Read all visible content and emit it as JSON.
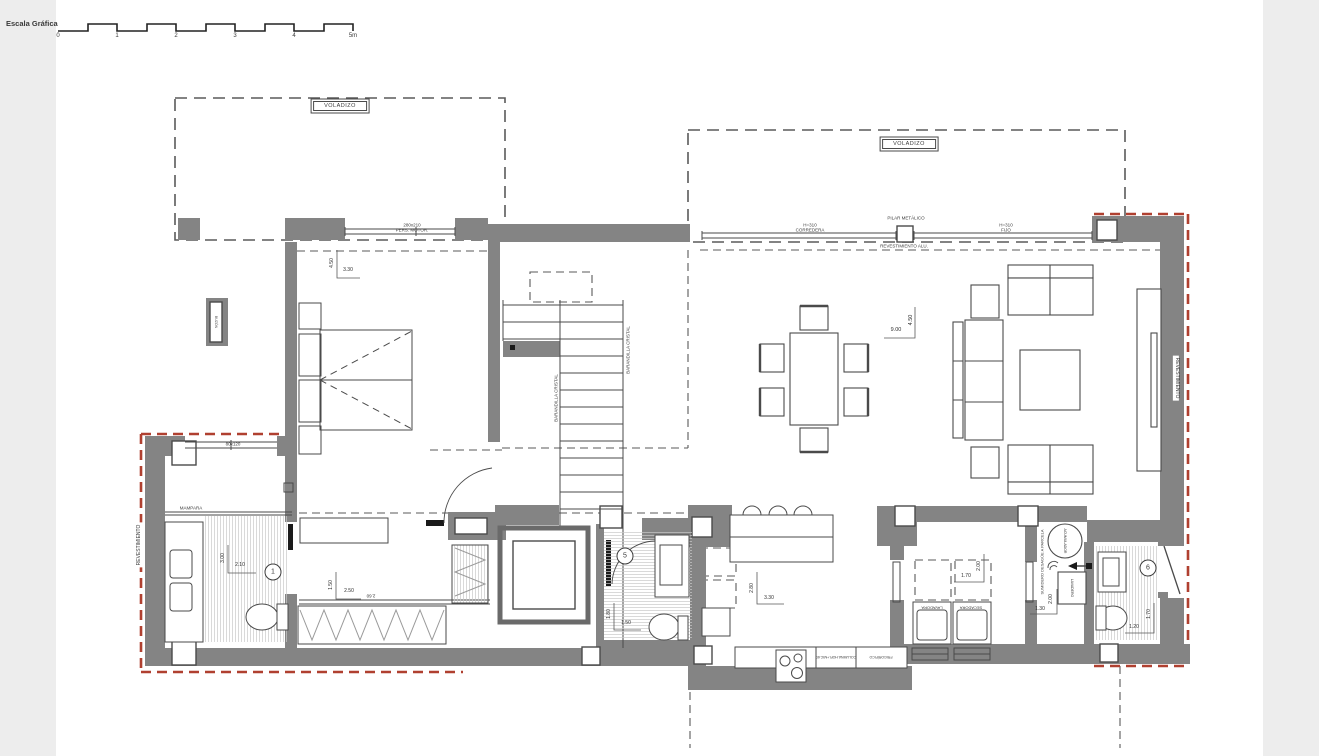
{
  "scale_bar": {
    "title": "Escala Gráfica",
    "ticks": [
      "0",
      "1",
      "2",
      "3",
      "4",
      "5m"
    ]
  },
  "annotations": {
    "voladizo_left": "VOLADIZO",
    "voladizo_right": "VOLADIZO",
    "bedroom_window_size": "280x210",
    "bedroom_window_type": "PERS. MOTOR.",
    "corredera_height": "H=310",
    "corredera": "CORREDERA",
    "pilar_metalico": "PILAR METÁLICO",
    "fijo_height": "H=310",
    "fijo": "FIJO",
    "revestimiento_alu": "REVESTIMIENTO ALU.",
    "barandilla_left": "BARANDILLA CRISTAL",
    "barandilla_right": "BARANDILLA CRISTAL",
    "revestimiento_left": "REVESTIMIENTO",
    "revestimiento_right": "REVESTIMIENTO",
    "buzon": "BUZÓN",
    "bath1_window": "80x120",
    "mampara": "MAMPARA",
    "lavadora": "LAVADORA",
    "secadora": "SECADORA",
    "columna_horno": "COLUMNA HOR.+MIC.60",
    "frigorifico": "FRIGORÍFICO",
    "acumulador": "ACUMULADOR",
    "sumidero": "SUMIDERO DESAGÜE A PARCELA",
    "lavadero": "LAVADERO"
  },
  "room_numbers": {
    "bath1": "1",
    "bath5": "5",
    "bath6": "6"
  },
  "dimensions": {
    "bedroom_v": "4.50",
    "bedroom_h": "3.30",
    "living_h": "9.00",
    "living_v": "4.50",
    "bath1_v": "3.00",
    "bath1_h": "2.10",
    "dressing_v": "1.50",
    "dressing_h": "2.50",
    "dressing_alt": "2.60",
    "bath5_v": "1.80",
    "bath5_h": "1.50",
    "kitchen_v": "2.80",
    "kitchen_h": "3.30",
    "laundry_h": "1.70",
    "laundry_v": "2.00",
    "utility_v": "2.00",
    "utility_h": "1.30",
    "bath6_h": "1.20",
    "bath6_v": "1.70"
  },
  "colors": {
    "wall": "#848484",
    "line": "#4a4a4a",
    "red_cladding": "#b04030",
    "hatch": "#c9c9c9"
  }
}
